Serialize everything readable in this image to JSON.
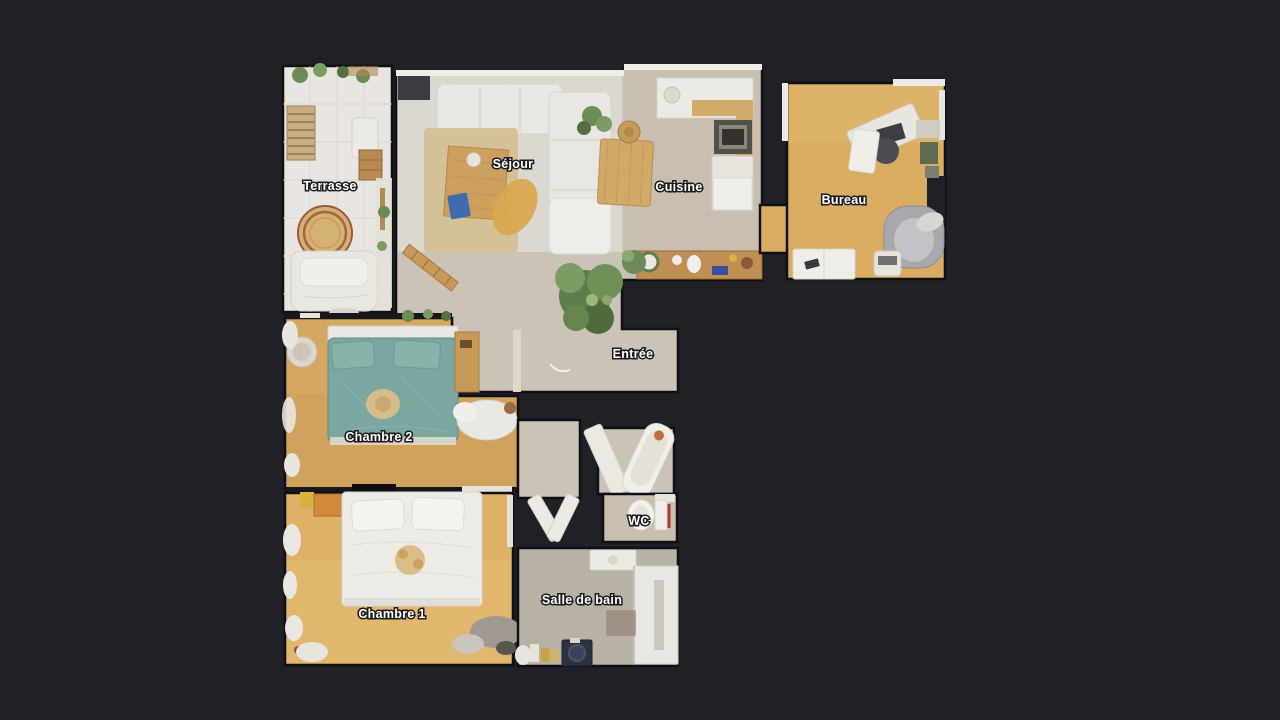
{
  "view": {
    "description": "Apartment floor plan, top-down dollhouse view on dark background"
  },
  "rooms": [
    {
      "id": "terrasse",
      "label": "Terrasse"
    },
    {
      "id": "sejour",
      "label": "Séjour"
    },
    {
      "id": "cuisine",
      "label": "Cuisine"
    },
    {
      "id": "bureau",
      "label": "Bureau"
    },
    {
      "id": "entree",
      "label": "Entrée"
    },
    {
      "id": "chambre2",
      "label": "Chambre 2"
    },
    {
      "id": "chambre1",
      "label": "Chambre 1"
    },
    {
      "id": "wc",
      "label": "WC"
    },
    {
      "id": "salle_de_bain",
      "label": "Salle de bain"
    }
  ],
  "colors": {
    "background": "#1f2126",
    "wall": "#0f1013",
    "tile_floor": "#e9e6e1",
    "stone_floor": "#cac3b6",
    "kitchen_floor": "#c8bfb1",
    "sejour_floor": "#dbd8d1",
    "wood_chambre2": "#cfa35d",
    "wood_chambre1": "#ddb167",
    "wood_bureau": "#d9ac62",
    "bath_floor": "#b8b1a5",
    "bed_teal": "#7aa8a0",
    "rug_beige": "#d5c093",
    "sofa_white": "#e9e7e1",
    "plant_green": "#6b8c55",
    "label_text": "#ffffff",
    "label_outline": "#1c1c1c"
  }
}
